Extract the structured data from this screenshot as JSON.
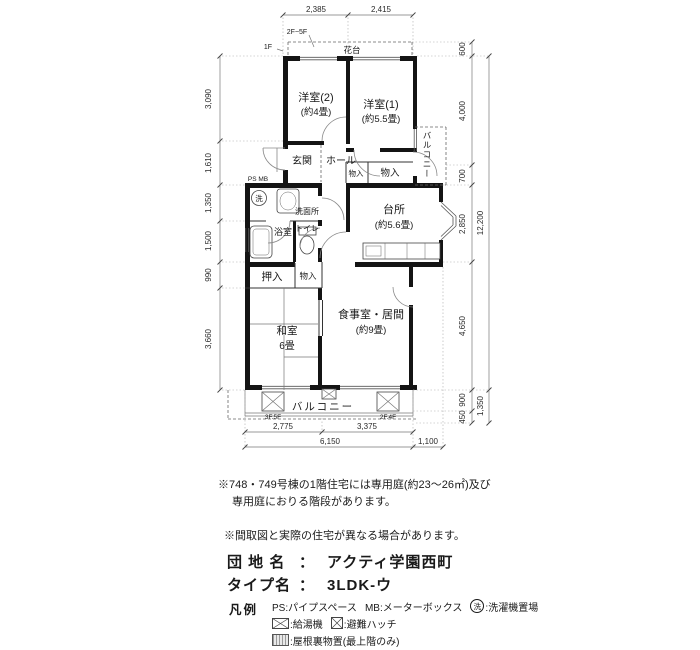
{
  "rooms": {
    "western2": {
      "name": "洋室(2)",
      "area": "(約4畳)"
    },
    "western1": {
      "name": "洋室(1)",
      "area": "(約5.5畳)"
    },
    "entrance": "玄関",
    "hall": "ホール",
    "closet_small": "物入",
    "closet_hall": "物入",
    "kitchen": {
      "name": "台所",
      "area": "(約5.6畳)"
    },
    "washroom": "洗面所",
    "bathroom": "浴室",
    "toilet": "トイレ",
    "oshiire": "押入",
    "closet_lower": "物入",
    "japanese": {
      "name": "和室",
      "area": "6畳"
    },
    "living": {
      "name": "食事室・居間",
      "area": "(約9畳)"
    },
    "balcony_side": "バルコニー",
    "balcony_main": "バルコニー",
    "flower_stand": "花台",
    "laundry_mark": "洗"
  },
  "marks": {
    "ps_mb": "PS MB",
    "floor2_5": "2F~5F",
    "floor1": "1F",
    "hatch_left": "3F.5F",
    "hatch_right": "2F.4F"
  },
  "dims": {
    "top": [
      "2,385",
      "2,415"
    ],
    "left": [
      "3,090",
      "1,610",
      "1,350",
      "1,500",
      "990",
      "3,660"
    ],
    "right": [
      "600",
      "4,000",
      "700",
      "2,850",
      "4,650",
      "900",
      "450"
    ],
    "right_outer": [
      "12,200",
      "1,350"
    ],
    "bottom_upper": [
      "2,775",
      "3,375"
    ],
    "bottom_lower": [
      "6,150",
      "1,100"
    ]
  },
  "notes": {
    "line1": "※748・749号棟の1階住宅には専用庭(約23～26㎡)及び",
    "line2": "専用庭におりる階段があります。",
    "line3": "※間取図と実際の住宅が異なる場合があります。"
  },
  "info": {
    "estate_label": "団 地 名",
    "estate_value": "アクティ学園西町",
    "type_label": "タイプ名",
    "type_value": "3LDK-ウ",
    "separator": "："
  },
  "legend": {
    "title": "凡例",
    "ps": "PS:パイプスペース",
    "mb": "MB:メーターボックス",
    "wash_symbol": "洗",
    "wash_label": ":洗濯機置場",
    "heater_label": ":給湯機",
    "hatch_label": ":避難ハッチ",
    "attic_label": ":屋根裏物置(最上階のみ)"
  }
}
